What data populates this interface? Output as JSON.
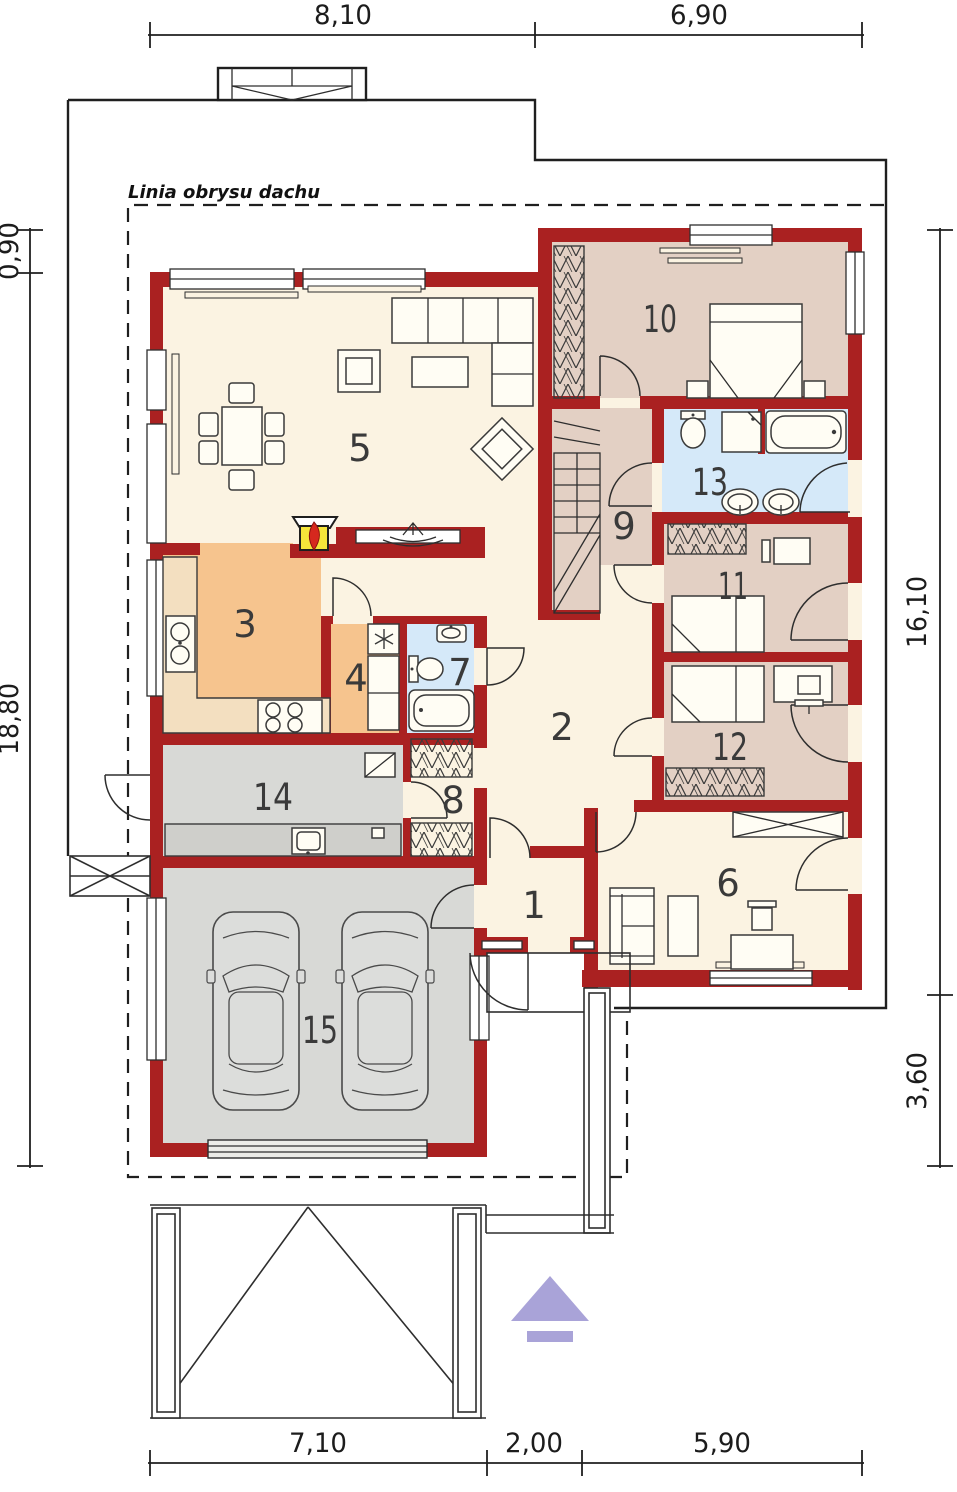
{
  "plan": {
    "roof_outline_label": "Linia obrysu dachu",
    "type": "house floor plan"
  },
  "rooms": [
    "1",
    "2",
    "3",
    "4",
    "5",
    "6",
    "7",
    "8",
    "9",
    "10",
    "11",
    "12",
    "13",
    "14",
    "15"
  ],
  "dims": {
    "top": [
      "8,10",
      "6,90"
    ],
    "left": [
      "0,90",
      "18,80"
    ],
    "right": [
      "16,10",
      "3,60"
    ],
    "bottom": [
      "7,10",
      "2,00",
      "5,90"
    ]
  },
  "colors": {
    "wall_red": "#AA2121",
    "floor_cream": "#FBF3E2",
    "floor_tan": "#E3D0C4",
    "floor_orange": "#F6C48E",
    "floor_blue": "#D5E9F9",
    "floor_gray": "#D8D9D6",
    "counter_orange": "#F3DFC0",
    "counter_gray": "#CFCFCB",
    "garage_door": "#ECECE8",
    "fireplace_yellow": "#F6E53A",
    "flame_red": "#D6281E",
    "arrow_purple": "#A9A3D8",
    "line_dark": "#2E2E2E"
  },
  "icons": {
    "entrance_arrow": "up-arrow",
    "fireplace": "fireplace-flame",
    "fridge": "snowflake",
    "cars": 2
  }
}
